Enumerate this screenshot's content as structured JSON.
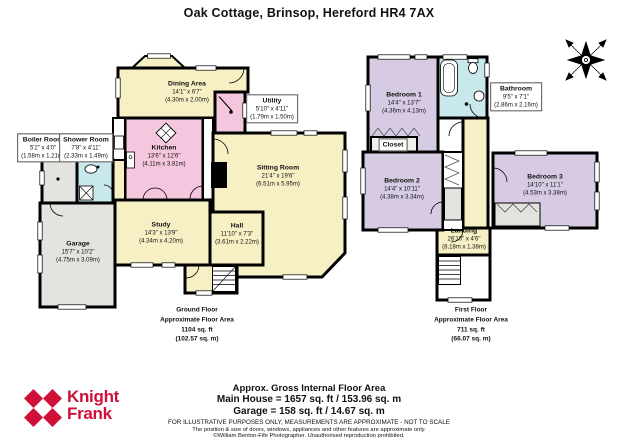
{
  "title": "Oak Cottage, Brinsop, Hereford HR4 7AX",
  "colors": {
    "wall": "#000000",
    "cream": "#F7F0C5",
    "pink": "#F4C7DE",
    "blue": "#C9E8EC",
    "lilac": "#D7CBE3",
    "grey": "#E3E3DF",
    "brand_red": "#D01039"
  },
  "ground_floor": {
    "rooms": {
      "dining": {
        "name": "Dining Area",
        "imperial": "14'1\" x 6'7\"",
        "metric": "(4.30m x 2.00m)"
      },
      "utility": {
        "name": "Utility",
        "imperial": "5'10\" x 4'11\"",
        "metric": "(1.79m x 1.50m)"
      },
      "kitchen": {
        "name": "Kitchen",
        "imperial": "13'6\" x 12'6\"",
        "metric": "(4.11m x 3.81m)"
      },
      "boiler": {
        "name": "Boiler Room",
        "imperial": "5'2\" x 4'0\"",
        "metric": "(1.58m x 1.21m)"
      },
      "shower": {
        "name": "Shower Room",
        "imperial": "7'8\" x 4'11\"",
        "metric": "(2.33m x 1.49m)"
      },
      "study": {
        "name": "Study",
        "imperial": "14'3\" x 13'9\"",
        "metric": "(4.34m x 4.20m)"
      },
      "hall": {
        "name": "Hall",
        "imperial": "11'10\" x 7'3\"",
        "metric": "(3.61m x 2.22m)"
      },
      "sitting": {
        "name": "Sitting Room",
        "imperial": "21'4\" x 19'6\"",
        "metric": "(6.51m x 5.95m)"
      },
      "garage": {
        "name": "Garage",
        "imperial": "15'7\" x 10'2\"",
        "metric": "(4.75m x 3.09m)"
      }
    },
    "label": {
      "l1": "Ground Floor",
      "l2": "Approximate Floor Area",
      "l3": "1104 sq. ft",
      "l4": "(102.57 sq. m)"
    }
  },
  "first_floor": {
    "rooms": {
      "bedroom1": {
        "name": "Bedroom 1",
        "imperial": "14'4\" x 13'7\"",
        "metric": "(4.36m x 4.13m)"
      },
      "bathroom": {
        "name": "Bathroom",
        "imperial": "9'5\" x 7'1\"",
        "metric": "(2.86m x 2.16m)"
      },
      "closet": {
        "name": "Closet"
      },
      "bedroom2": {
        "name": "Bedroom 2",
        "imperial": "14'4\" x 10'11\"",
        "metric": "(4.38m x 3.34m)"
      },
      "bedroom3": {
        "name": "Bedroom 3",
        "imperial": "14'10\" x 11'1\"",
        "metric": "(4.53m x 3.38m)"
      },
      "landing": {
        "name": "Landing",
        "imperial": "26'10\" x 4'6\"",
        "metric": "(8.18m x 1.38m)"
      }
    },
    "label": {
      "l1": "First Floor",
      "l2": "Approximate Floor Area",
      "l3": "711 sq. ft",
      "l4": "(66.07 sq. m)"
    }
  },
  "footer": {
    "brand_line1": "Knight",
    "brand_line2": "Frank",
    "area_title": "Approx. Gross Internal Floor Area",
    "main_house": "Main House = 1657 sq. ft / 153.96 sq. m",
    "garage_line": "Garage = 158 sq. ft / 14.67 sq. m",
    "disclaimer1": "FOR ILLUSTRATIVE PURPOSES ONLY, MEASUREMENTS ARE APPROXIMATE - NOT TO SCALE",
    "disclaimer2": "The position & size of doors, windows, appliances and other features are approximate only.",
    "disclaimer3": "©William Benton-Fife Photographer. Unauthorised reproduction prohibited."
  }
}
